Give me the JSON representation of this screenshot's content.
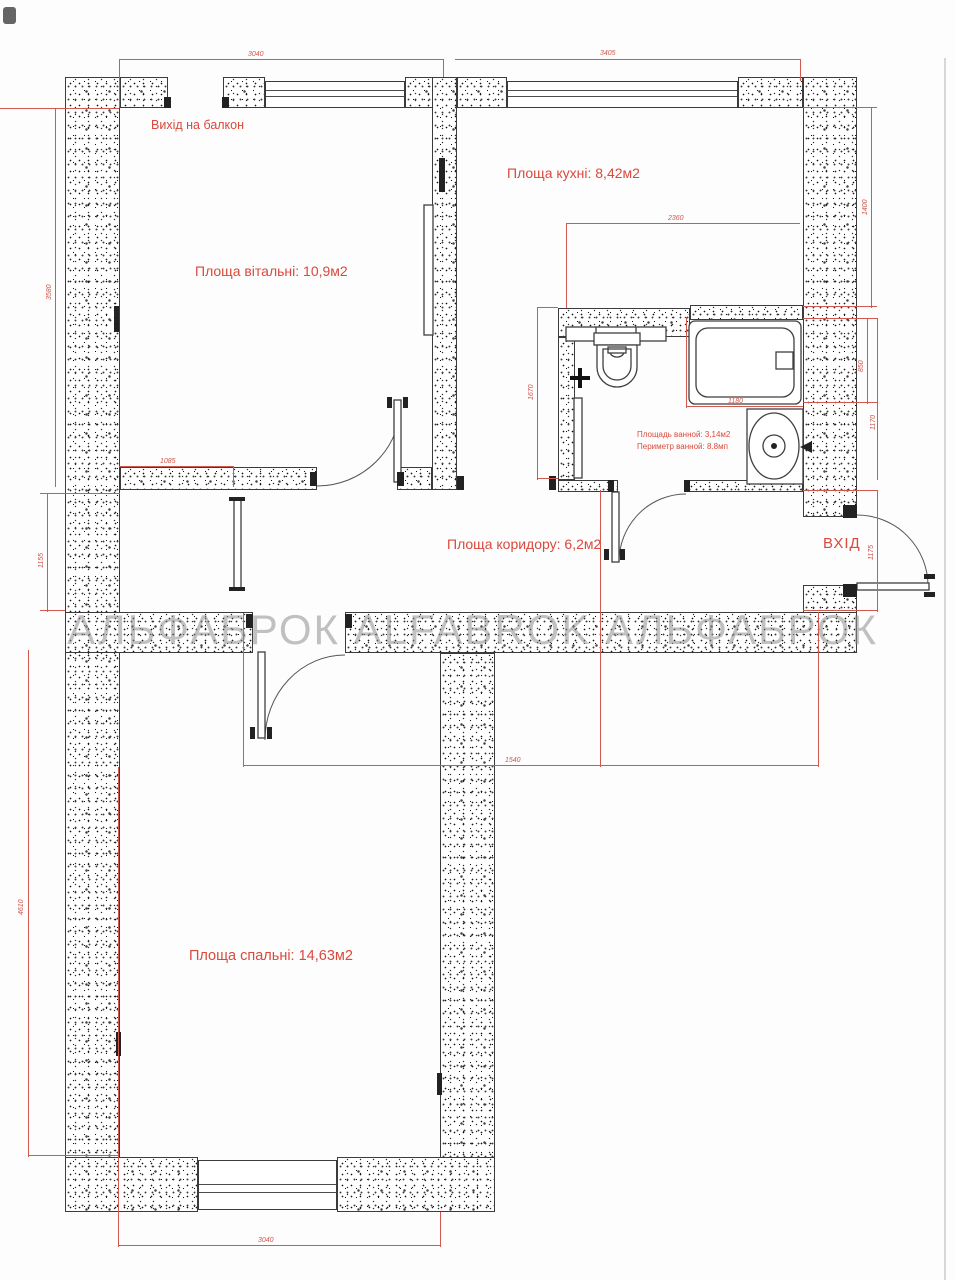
{
  "plan": {
    "watermark": "АЛЬФАБРОК ALFABROK АЛЬФАБРОК",
    "labels": {
      "balcony_exit": "Вихід на балкон",
      "living_room": "Площа вітальні: 10,9м2",
      "kitchen": "Площа кухні: 8,42м2",
      "corridor": "Площа коридору: 6,2м2",
      "bedroom": "Площа спальні: 14,63м2",
      "bath_area": "Площадь ванной: 3,14м2",
      "bath_perimeter": "Периметр ванной: 8.8мп",
      "entrance": "ВХІД"
    },
    "dimensions": {
      "living_width_top": "3040",
      "kitchen_width_top": "3405",
      "living_height_left": "3580",
      "corridor_left": "1155",
      "living_door_offset": "1085",
      "kitchen_inner_width": "2360",
      "bath_height_left": "1670",
      "bath_tub_width": "1180",
      "kitchen_right_height": "1400",
      "tub_right_height": "850",
      "bath_right_height": "1170",
      "entry_right_height": "1175",
      "corridor_bottom_width": "1540",
      "bedroom_height_left": "4610",
      "bedroom_width_bottom": "3040"
    },
    "colors": {
      "dimension_red": "#d05a4f",
      "label_red": "#d9493c",
      "watermark_gray": "#8f8f8f",
      "wall_outline": "#3b3b3b"
    }
  }
}
